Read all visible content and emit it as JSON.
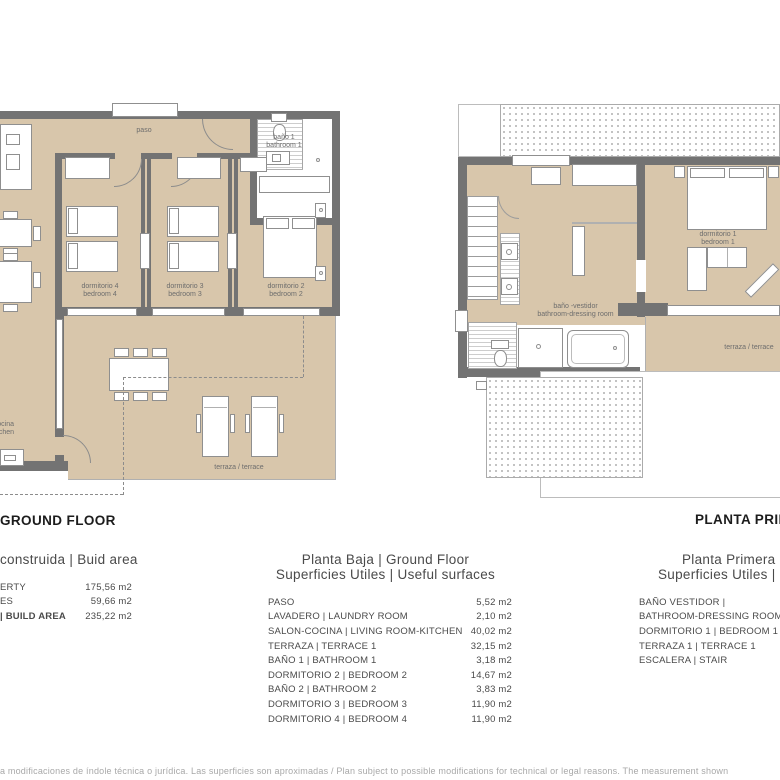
{
  "plan_ground": {
    "title": "GROUND FLOOR",
    "room_labels": {
      "paso": "paso",
      "bath1_line1": "baño 1",
      "bath1_line2": "bathroom 1",
      "bed4_line1": "dormitorio 4",
      "bed4_line2": "bedroom 4",
      "bed3_line1": "dormitorio 3",
      "bed3_line2": "bedroom 3",
      "bed2_line1": "dormitorio 2",
      "bed2_line2": "bedroom 2",
      "kitchen_line1": "salón-cocina",
      "kitchen_line2": "living room-kitchen",
      "terrace": "terraza / terrace"
    }
  },
  "plan_first": {
    "title": "PLANTA PRIMERA",
    "room_labels": {
      "bath_line1": "baño -vestidor",
      "bath_line2": "bathroom-dressing room",
      "bed1_line1": "dormitorio 1",
      "bed1_line2": "bedroom 1",
      "terrace": "terraza / terrace"
    }
  },
  "tables": {
    "build_area": {
      "header": "construida | Buid area",
      "rows": [
        {
          "label": "ERTY",
          "value": "175,56 m2",
          "bold": false
        },
        {
          "label": "ES",
          "value": "59,66 m2",
          "bold": false
        },
        {
          "label": "| BUILD AREA",
          "value": "235,22 m2",
          "bold": true
        }
      ]
    },
    "planta_baja": {
      "title_line1": "Planta Baja | Ground Floor",
      "title_line2": "Superficies Utiles | Useful surfaces",
      "rows": [
        {
          "label": "PASO",
          "value": "5,52 m2"
        },
        {
          "label": "LAVADERO | LAUNDRY ROOM",
          "value": "2,10 m2"
        },
        {
          "label": "SALON-COCINA | LIVING ROOM-KITCHEN",
          "value": "40,02 m2"
        },
        {
          "label": "TERRAZA | TERRACE 1",
          "value": "32,15 m2"
        },
        {
          "label": "BAÑO 1 | BATHROOM 1",
          "value": "3,18 m2"
        },
        {
          "label": "DORMITORIO 2 | BEDROOM 2",
          "value": "14,67 m2"
        },
        {
          "label": "BAÑO 2 | BATHROOM 2",
          "value": "3,83 m2"
        },
        {
          "label": "DORMITORIO 3 | BEDROOM 3",
          "value": "11,90 m2"
        },
        {
          "label": "DORMITORIO 4 | BEDROOM 4",
          "value": "11,90 m2"
        }
      ]
    },
    "planta_primera": {
      "title_line1": "Planta Primera | First Floor",
      "title_line2": "Superficies Utiles | Useful surfaces",
      "rows": [
        {
          "label": "BAÑO VESTIDOR |"
        },
        {
          "label": "BATHROOM-DRESSING ROOM"
        },
        {
          "label": "DORMITORIO 1 | BEDROOM 1"
        },
        {
          "label": "TERRAZA 1 | TERRACE 1"
        },
        {
          "label": "ESCALERA | STAIR"
        }
      ]
    }
  },
  "footer": {
    "disclaimer": "a modificaciones de índole técnica o jurídica. Las superficies son aproximadas / Plan subject to possible modifications for technical or legal reasons. The measurement shown"
  },
  "colors": {
    "wall": "#737373",
    "room_fill": "#d8c6ab",
    "title_text": "#1c1c1c",
    "table_text": "#4a4a4a",
    "footer_text": "#a8a8a8"
  }
}
